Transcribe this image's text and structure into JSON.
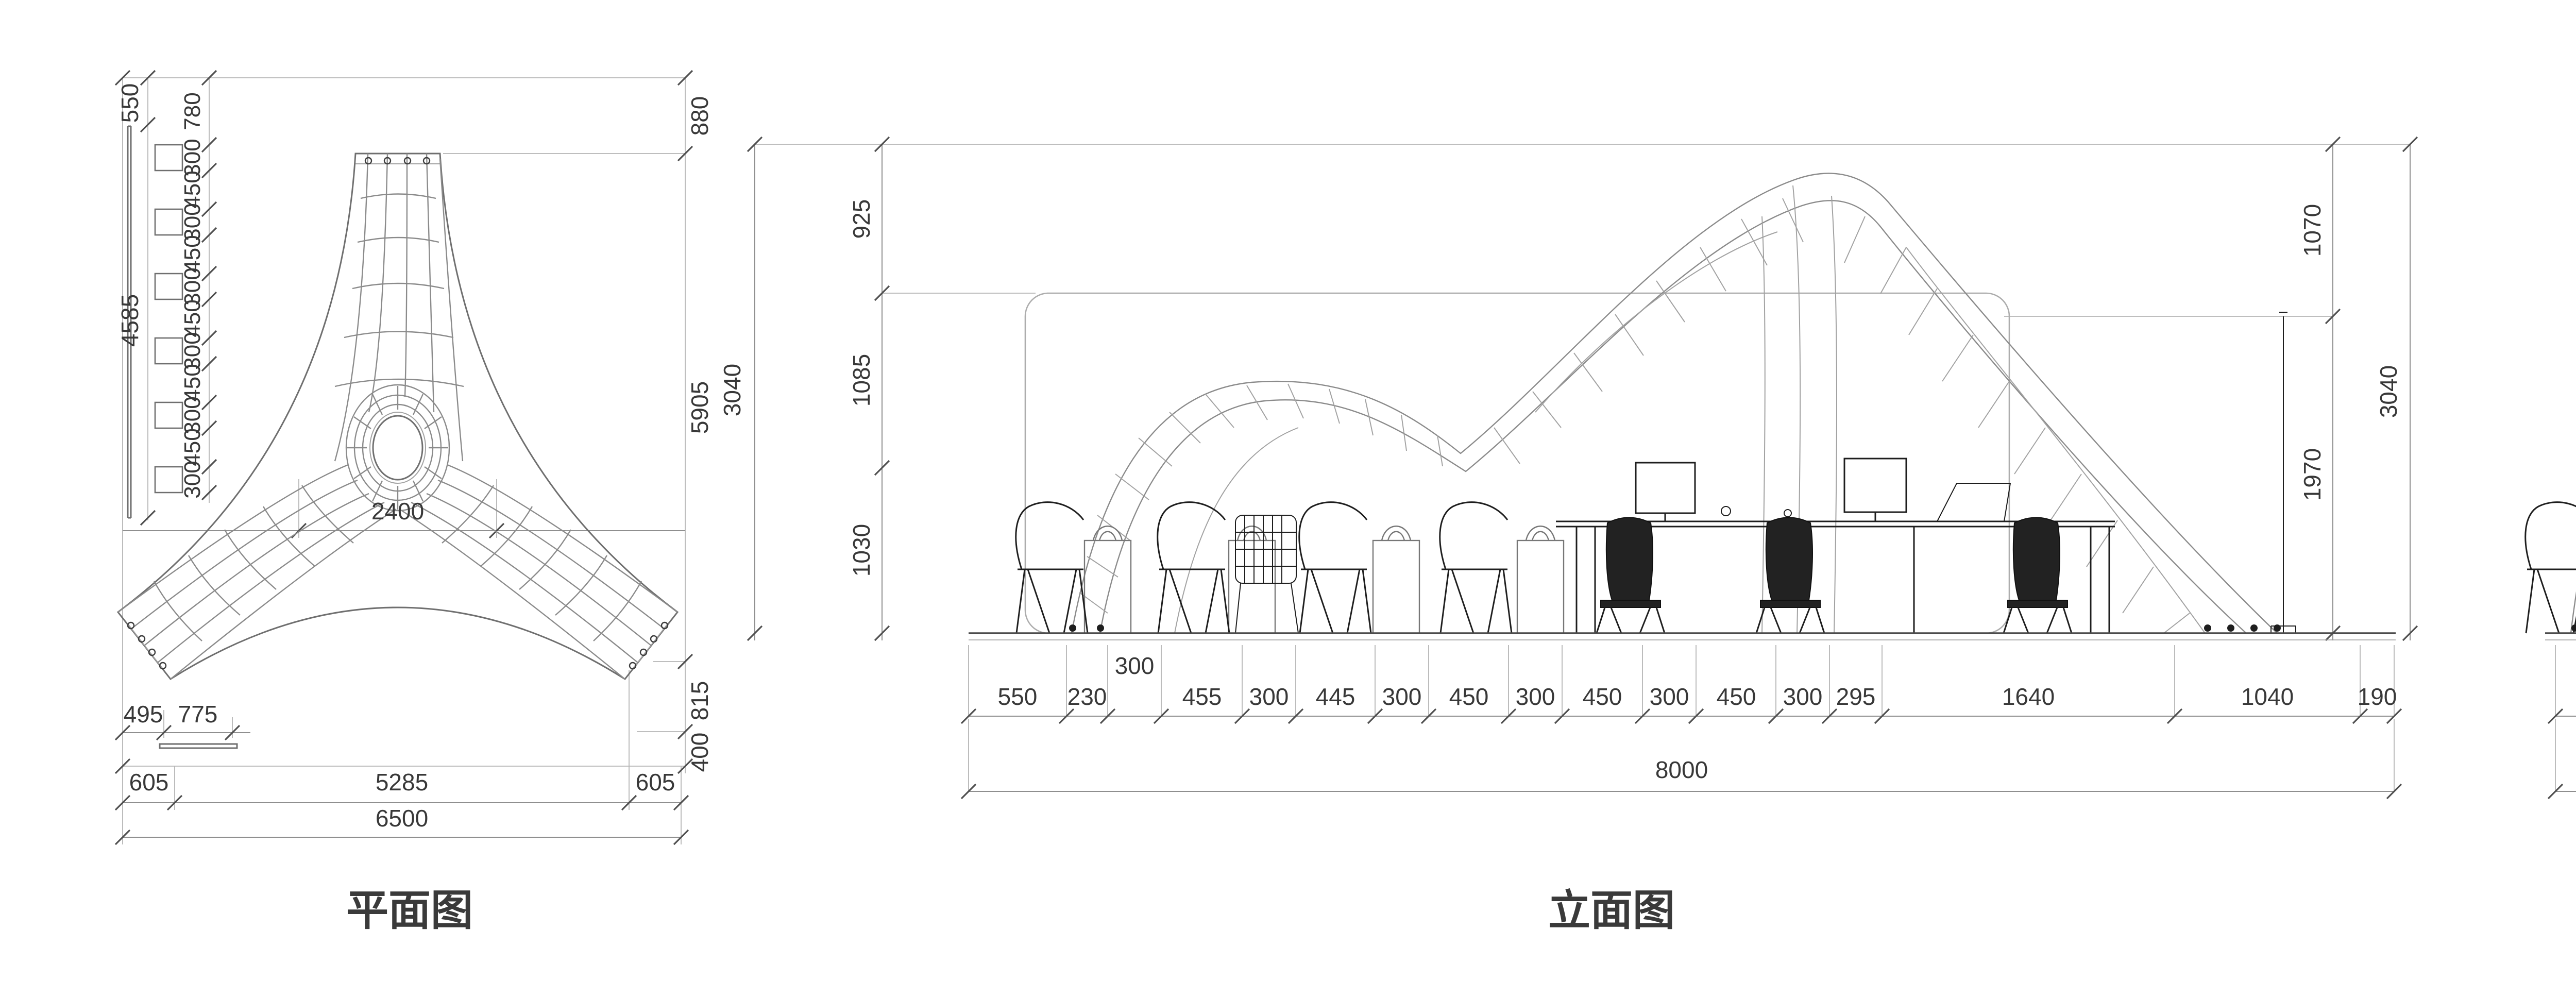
{
  "plan": {
    "caption": "平面图",
    "left_outer": [
      "550",
      "4585"
    ],
    "left_inner": [
      "780",
      "300",
      "450",
      "300",
      "450",
      "300",
      "450",
      "300",
      "450",
      "300",
      "450",
      "300"
    ],
    "right": [
      "880",
      "5905",
      "815",
      "400"
    ],
    "center_dim": "2400",
    "bottom_offsets": [
      "495",
      "775"
    ],
    "bottom_row": [
      "605",
      "5285",
      "605"
    ],
    "total": "6500"
  },
  "elev1": {
    "caption": "立面图",
    "left": [
      "925",
      "1085",
      "1030"
    ],
    "left_total": "3040",
    "right": [
      "1070",
      "1970"
    ],
    "right_total": "3040",
    "offset_dim": "300",
    "bottom_row": [
      "550",
      "230",
      "455",
      "300",
      "445",
      "300",
      "450",
      "300",
      "450",
      "300",
      "450",
      "300",
      "295",
      "1640",
      "1040",
      "190"
    ],
    "total": "8000"
  },
  "elev2": {
    "caption": "立面图",
    "watermark": "12C18",
    "right": [
      "925",
      "310",
      "1020",
      "780"
    ],
    "right_total": "3040",
    "bottom_row": [
      "655",
      "2270",
      "705",
      "1625",
      "645",
      "135",
      "520"
    ],
    "total": "6500"
  },
  "colors": {
    "dim_text": "#383838",
    "line": "#8b8b8b",
    "furniture": "#1e1e1e",
    "watermark_stroke": "#b0b0b0",
    "background": "#ffffff"
  }
}
